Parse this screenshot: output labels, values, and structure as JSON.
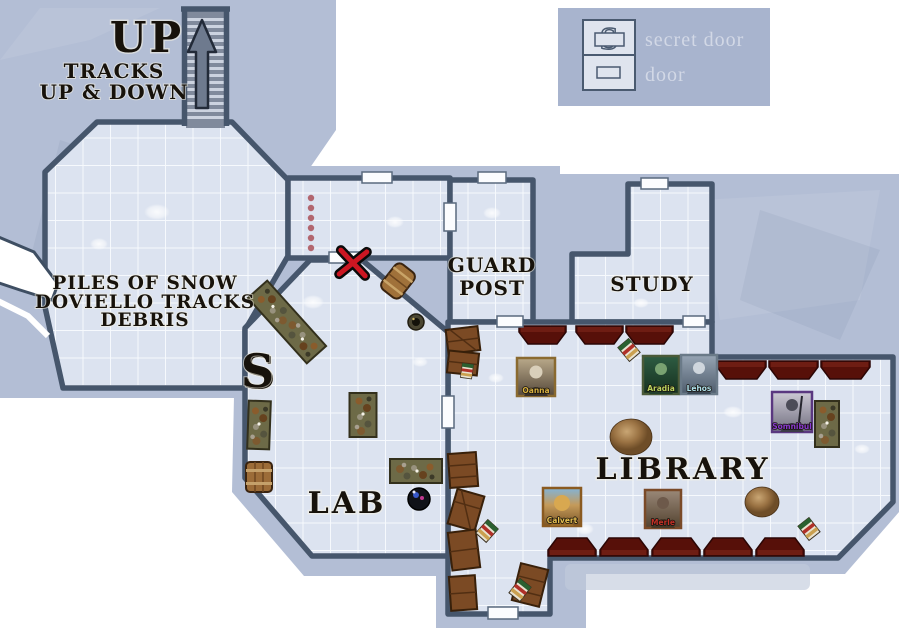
{
  "page": {
    "background": "#ffffff"
  },
  "legend": {
    "secret_icon_letter": "S",
    "secret_door_label": "secret door",
    "door_label": "door"
  },
  "map": {
    "stairs": {
      "label": "UP",
      "note_line1": "TRACKS",
      "note_line2": "UP & DOWN"
    },
    "rooms": {
      "snow_room": {
        "line1": "PILES OF SNOW",
        "line2": "DOVIELLO TRACKS",
        "line3": "DEBRIS"
      },
      "guard_post": {
        "line1": "GUARD",
        "line2": "POST"
      },
      "study": {
        "label": "STUDY"
      },
      "library": {
        "label": "LIBRARY"
      },
      "lab": {
        "label": "LAB"
      }
    },
    "secret_door_marker": "S",
    "tokens": [
      {
        "name": "Oanna"
      },
      {
        "name": "Aradia"
      },
      {
        "name": "Lehos"
      },
      {
        "name": "Somnibul"
      },
      {
        "name": "Calvert"
      },
      {
        "name": "Merle"
      }
    ]
  },
  "colors": {
    "map_background": "#b3bed5",
    "floor": "#dce3f0",
    "grid_line": "#f6f9fd",
    "wall": "#46566c",
    "bench": "#5a140d",
    "table": "#6d6a47",
    "crate": "#7b4a24",
    "trail_dot": "#a84850",
    "x_marker_red": "#cc1622",
    "legend_text": "#d2d8e6"
  }
}
